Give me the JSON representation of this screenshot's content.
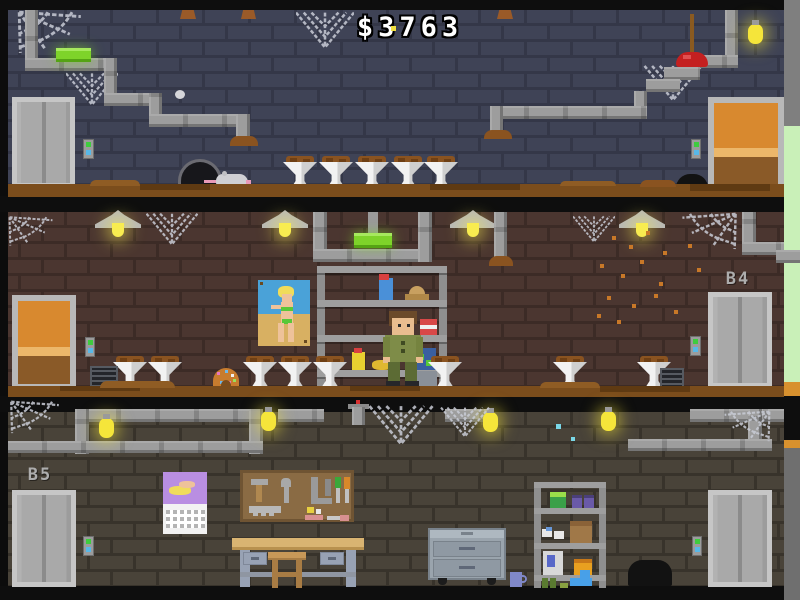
{
  "hud": {
    "money": "$3763"
  },
  "floors": {
    "b3": {
      "label": ""
    },
    "b4": {
      "label": "B4"
    },
    "b5": {
      "label": "B5"
    }
  },
  "objects": {
    "b3": [
      "elevator",
      "elevator-call-buttons",
      "grow-lamp",
      "pipes",
      "spider-webs",
      "grow-pots",
      "mouse-hole",
      "dead-rat",
      "moth",
      "plunger",
      "light-bulb",
      "wooden-door",
      "light-switch",
      "dirt-mounds",
      "trash-sack"
    ],
    "b4": [
      "ceiling-lamps",
      "spider-webs",
      "pipes",
      "grow-lamp",
      "pinup-poster",
      "storage-shelf",
      "worker-character",
      "grow-pots",
      "sprinkled-donut",
      "floor-vents",
      "spore-dots",
      "wooden-door",
      "light-switch",
      "elevator",
      "elevator-call-buttons"
    ],
    "b5": [
      "pipes",
      "light-bulbs",
      "spider-webs",
      "elevator",
      "elevator-call-buttons",
      "calendar",
      "pegboard-tools",
      "workbench",
      "stool",
      "tool-cabinet",
      "mug",
      "supply-shelf",
      "trash-sack"
    ]
  },
  "colors": {
    "wall_b3": "#3f4356",
    "wall_b4": "#4b3630",
    "wall_b5": "#494339",
    "dirt": "#7b4d1c",
    "pipe": "#9d9d9d",
    "grow_light_green": "#7ed32a",
    "bulb_yellow": "#f5e53a",
    "button_green": "#3ecc3e",
    "button_cyan": "#58b8e8",
    "door_orange": "#d8892f",
    "plunger_red": "#c42020",
    "edge_green": "#c9f0b8",
    "edge_orange": "#d8912e",
    "money_text": "#ffffff"
  }
}
